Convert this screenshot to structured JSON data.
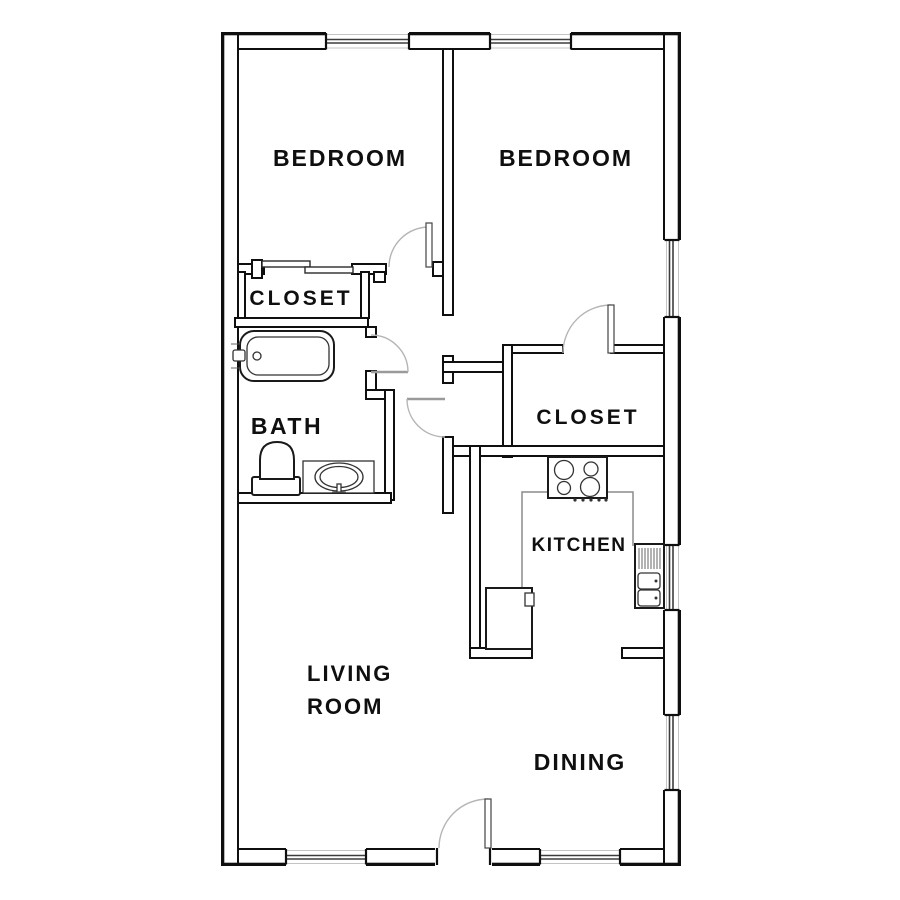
{
  "title": "Two-bedroom apartment floor plan",
  "rooms": {
    "bedroom1": {
      "label": "BEDROOM"
    },
    "bedroom2": {
      "label": "BEDROOM"
    },
    "closet1": {
      "label": "CLOSET"
    },
    "bath": {
      "label": "BATH"
    },
    "closet2": {
      "label": "CLOSET"
    },
    "kitchen": {
      "label": "KITCHEN"
    },
    "living": {
      "name": "LIVING ROOM",
      "line1": "LIVING",
      "line2": "ROOM"
    },
    "dining": {
      "label": "DINING"
    }
  },
  "fixtures": [
    "bathtub",
    "toilet",
    "bathroom-sink",
    "stove",
    "kitchen-sink",
    "refrigerator",
    "kitchen-counter"
  ],
  "features": {
    "windows": 7,
    "hinged_doors": 5,
    "sliding_closet_doors": 1,
    "entry_door_location": "bottom center"
  },
  "colors": {
    "walls": "#0f0f0f",
    "background": "#ffffff",
    "door_arc": "#b5b5b5",
    "window_line": "#3d3d3d"
  }
}
